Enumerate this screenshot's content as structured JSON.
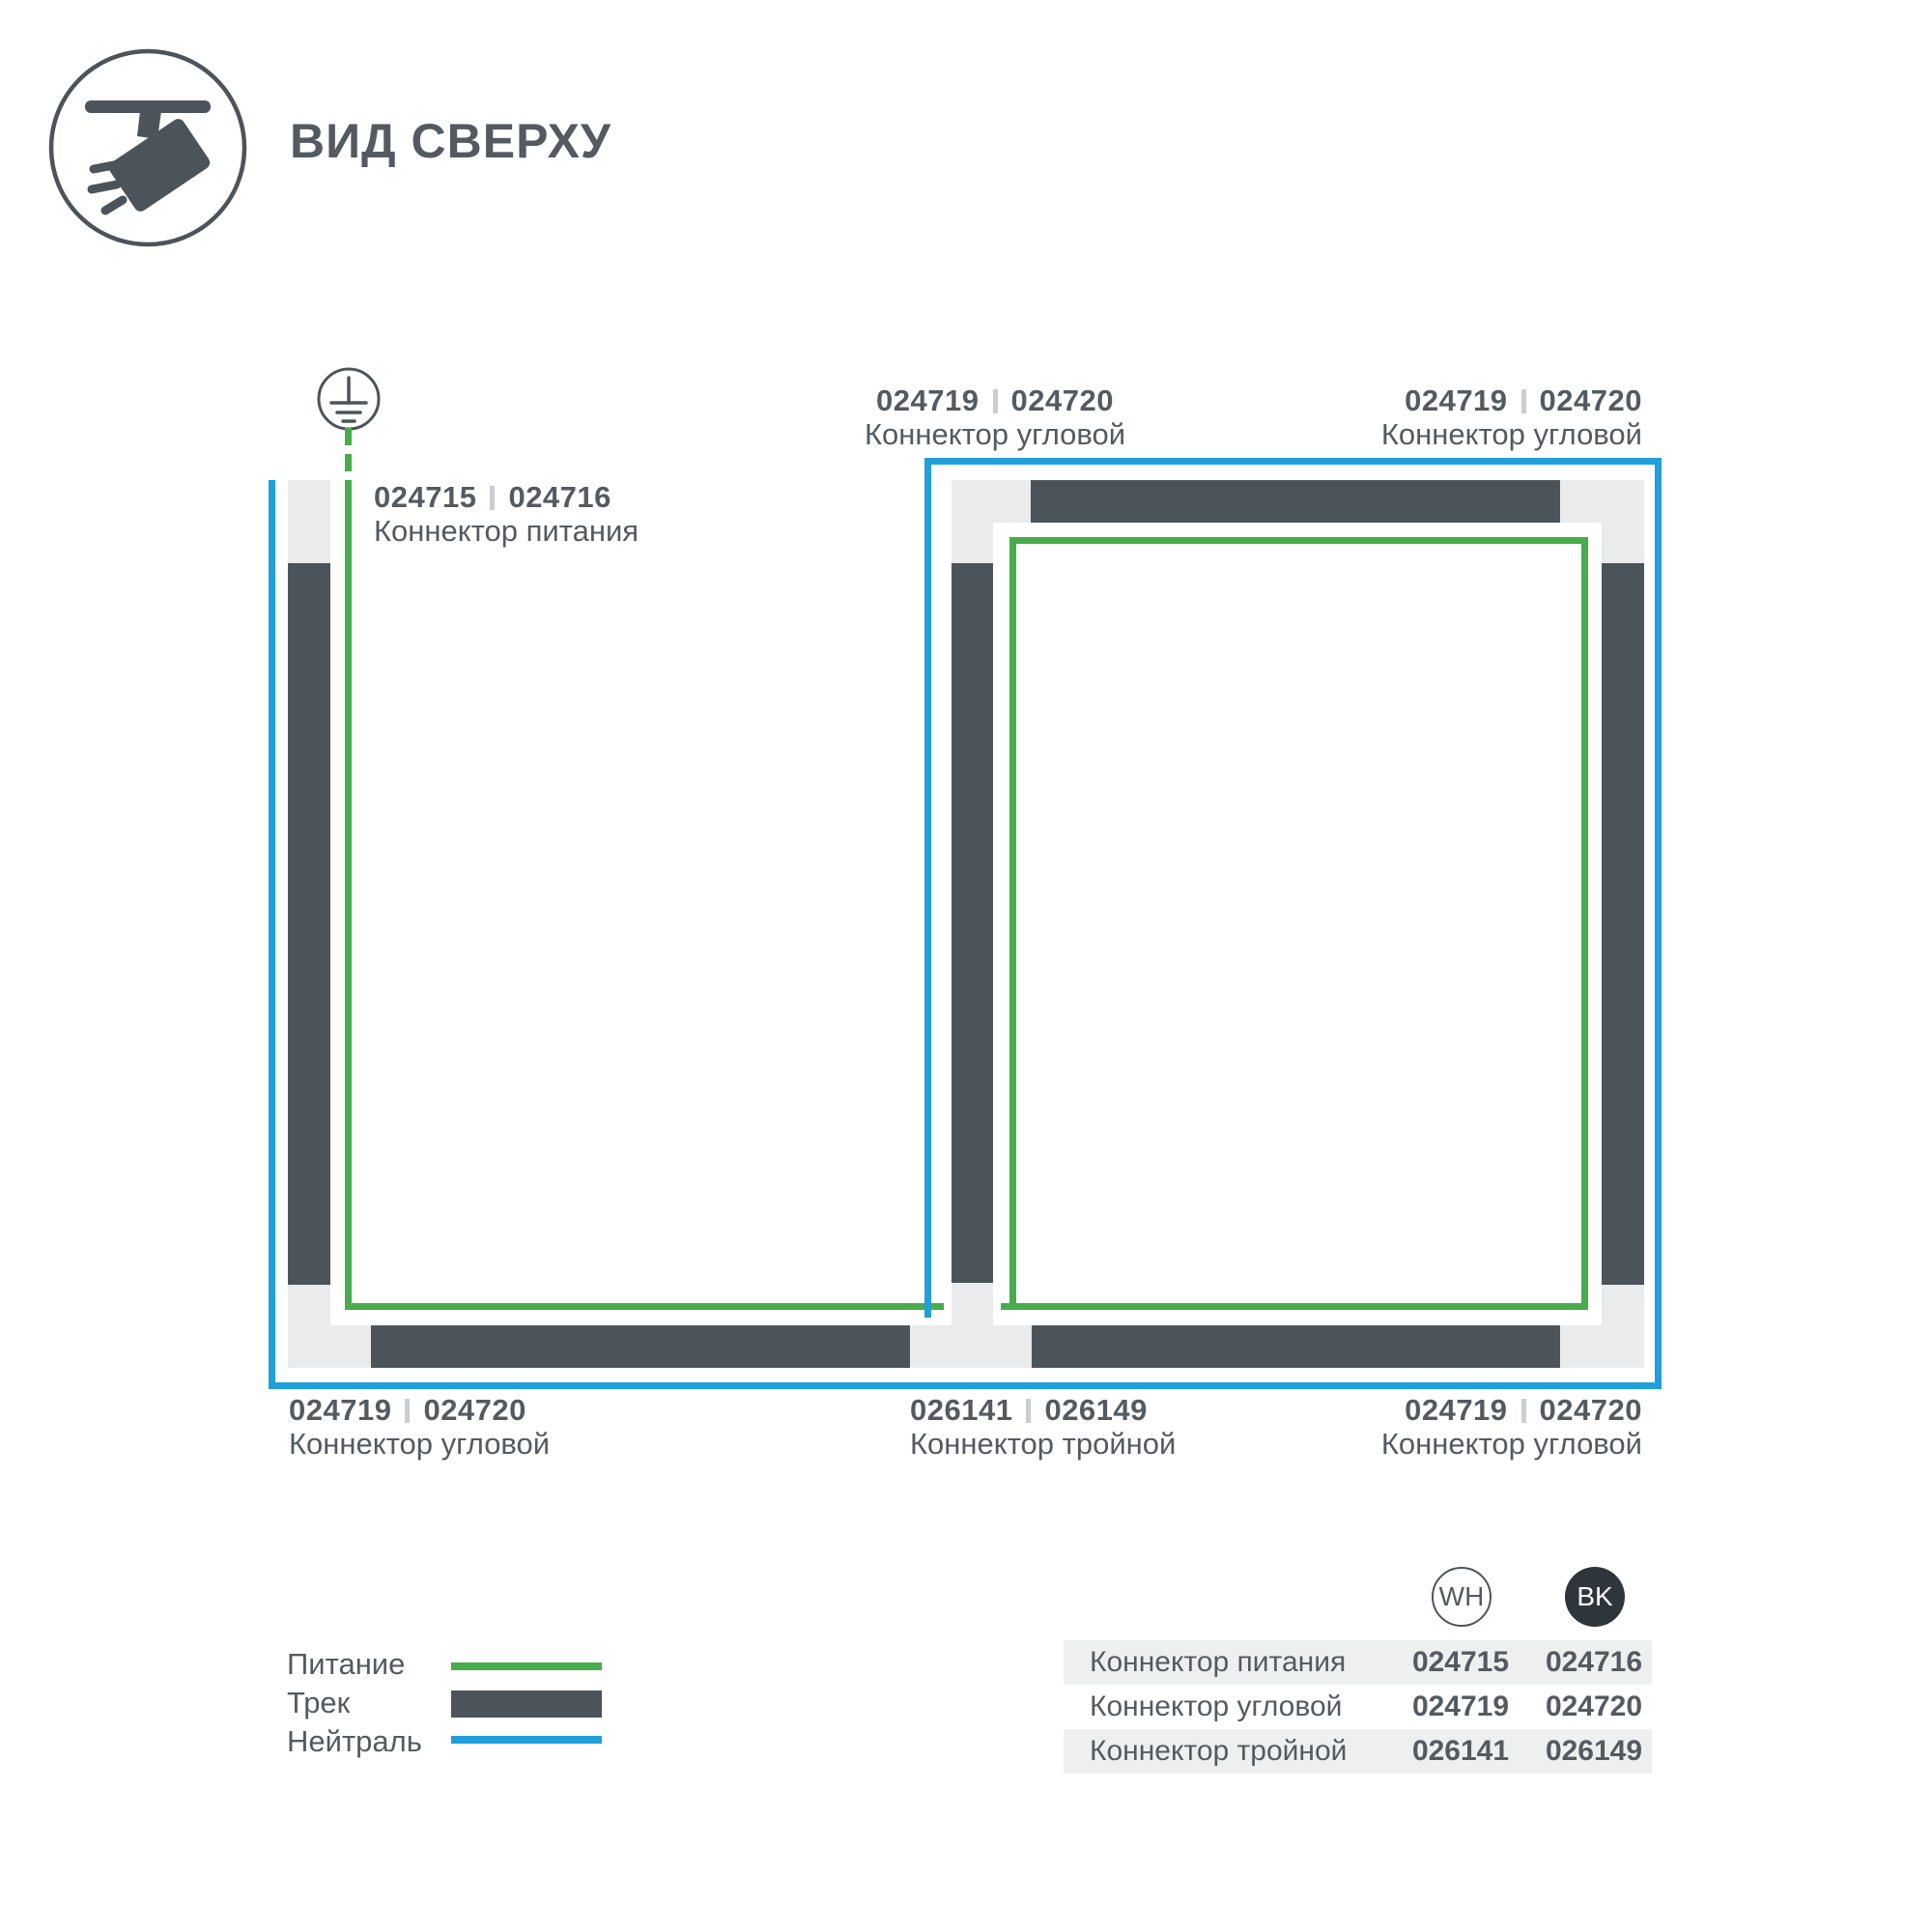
{
  "header": {
    "title": "ВИД СВЕРХУ"
  },
  "diagram": {
    "labels": {
      "power": {
        "wh": "024715",
        "bk": "024716",
        "name": "Коннектор питания"
      },
      "corner_top_center": {
        "wh": "024719",
        "bk": "024720",
        "name": "Коннектор угловой"
      },
      "corner_top_right": {
        "wh": "024719",
        "bk": "024720",
        "name": "Коннектор угловой"
      },
      "corner_bottom_left": {
        "wh": "024719",
        "bk": "024720",
        "name": "Коннектор угловой"
      },
      "triple_bottom_center": {
        "wh": "026141",
        "bk": "026149",
        "name": "Коннектор тройной"
      },
      "corner_bottom_right": {
        "wh": "024719",
        "bk": "024720",
        "name": "Коннектор угловой"
      }
    }
  },
  "legend": {
    "items": [
      {
        "label": "Питание",
        "swatch": "power-line"
      },
      {
        "label": "Трек",
        "swatch": "track"
      },
      {
        "label": "Нейтраль",
        "swatch": "neutral-line"
      }
    ]
  },
  "table": {
    "columns": [
      {
        "code": "WH"
      },
      {
        "code": "BK"
      }
    ],
    "rows": [
      {
        "name": "Коннектор питания",
        "wh": "024715",
        "bk": "024716"
      },
      {
        "name": "Коннектор угловой",
        "wh": "024719",
        "bk": "024720"
      },
      {
        "name": "Коннектор тройной",
        "wh": "026141",
        "bk": "026149"
      }
    ]
  },
  "colors": {
    "power_green": "#48ab4c",
    "neutral_blue": "#209fd9",
    "track_dark": "#4c545b",
    "connector_gray": "#e9ebec",
    "text_dark": "#535a61",
    "table_band": "#eef0f0",
    "bk_badge": "#2e353b",
    "separator_gray": "#c9ced2"
  }
}
